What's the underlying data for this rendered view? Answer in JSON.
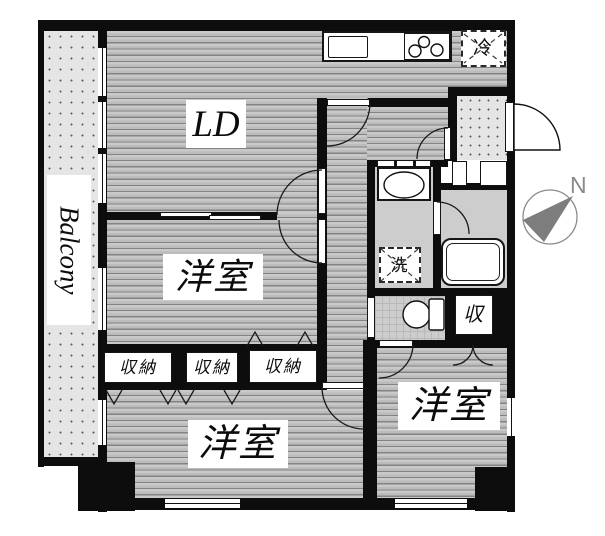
{
  "plan": {
    "balcony_label": "Balcony",
    "compass_north": "N",
    "rooms": {
      "ld": "LD",
      "bedroom_middle": "洋室",
      "bedroom_bottom_left": "洋室",
      "bedroom_bottom_right": "洋室"
    },
    "storage": {
      "closet1": "収納",
      "closet2": "収納",
      "closet3": "収納",
      "closet_small": "収"
    },
    "appliances": {
      "refrigerator": "冷",
      "washer": "洗"
    },
    "colors": {
      "wall": "#0d0d0d",
      "floor": "#c6c6c6",
      "floorline": "#7f7f7f",
      "dots": "#e5e5e5",
      "wet": "#cdcdcd",
      "gray": "#7d7d7d"
    }
  }
}
